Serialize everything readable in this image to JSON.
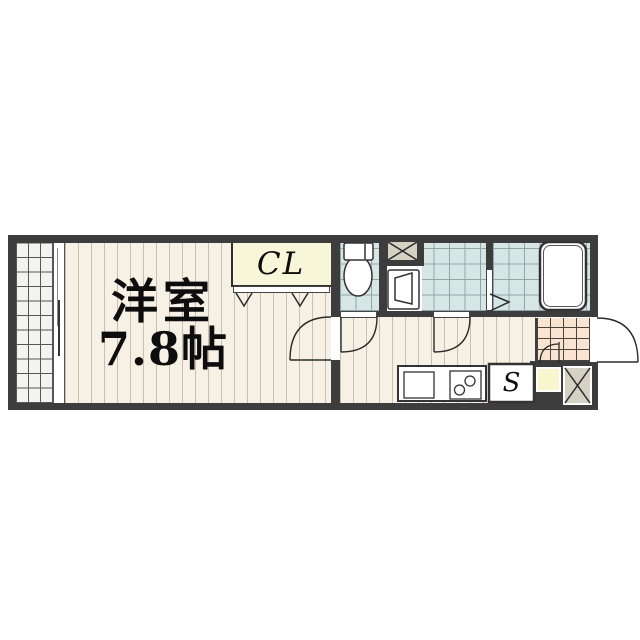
{
  "labels": {
    "western_room_name": "洋室",
    "western_room_size": "7.8帖",
    "closet_label": "CL",
    "storage_label": "S"
  },
  "colors": {
    "wall": "#3d3d3d",
    "room_floor": "#f6f0e5",
    "floor_stripe": "#c9c0b2",
    "wet_area_tile": "#d6e6e5",
    "wet_tile_grid": "#93a5a8",
    "entrance_tile": "#f9e3d1",
    "closet_fill": "#f8f6d8",
    "shoebox_fill": "#f8f6cc",
    "balcony_fill": "#f3f4ef",
    "shaft_fill": "#d5d1c3",
    "line": "#333333"
  }
}
